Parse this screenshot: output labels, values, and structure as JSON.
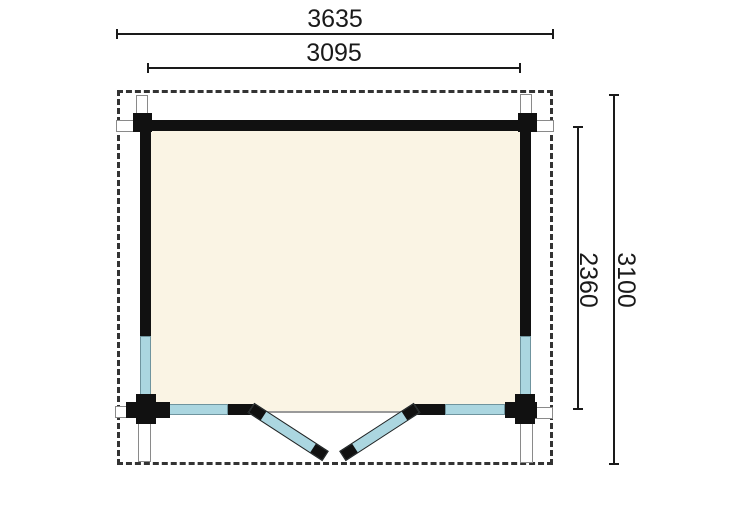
{
  "title": "Log cabin floor plan",
  "dimensions": {
    "top_outer": "3635",
    "top_inner": "3095",
    "right_outer": "3100",
    "right_inner": "2360"
  },
  "colors": {
    "wall": "#111111",
    "interior": "#faf4e4",
    "glazing": "#abd6e0",
    "glazing_border": "#6f949e",
    "outline": "#8a8a8a",
    "dash": "#333333",
    "dimension": "#1a1a1a",
    "background": "#ffffff"
  }
}
